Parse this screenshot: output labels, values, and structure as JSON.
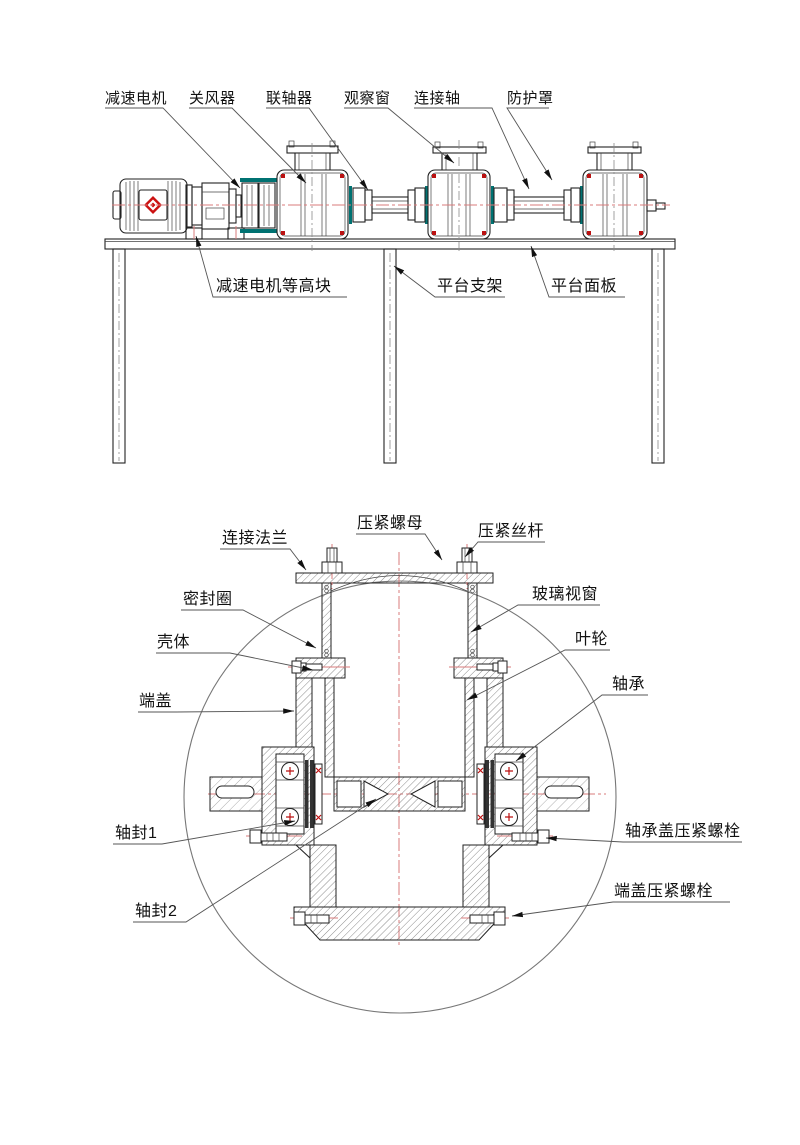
{
  "colors": {
    "centerline": "#d97b7b",
    "accent_red": "#bb1111",
    "teal": "#007272",
    "leader": "#555555",
    "line": "#222222",
    "logo_red": "#cc1111"
  },
  "top_view": {
    "labels": {
      "gear_motor": "减速电机",
      "rotary_valve": "关风器",
      "coupling": "联轴器",
      "observation_window": "观察窗",
      "connecting_shaft": "连接轴",
      "protective_cover": "防护罩",
      "motor_riser_block": "减速电机等高块",
      "platform_support": "平台支架",
      "platform_panel": "平台面板"
    }
  },
  "section_view": {
    "labels": {
      "connecting_flange": "连接法兰",
      "compression_nut": "压紧螺母",
      "compression_screw": "压紧丝杆",
      "seal_ring": "密封圈",
      "glass_window": "玻璃视窗",
      "housing": "壳体",
      "impeller": "叶轮",
      "end_cover": "端盖",
      "bearing": "轴承",
      "shaft_seal_1": "轴封1",
      "shaft_seal_2": "轴封2",
      "bearing_cover_bolt": "轴承盖压紧螺栓",
      "end_cover_bolt": "端盖压紧螺栓"
    }
  }
}
